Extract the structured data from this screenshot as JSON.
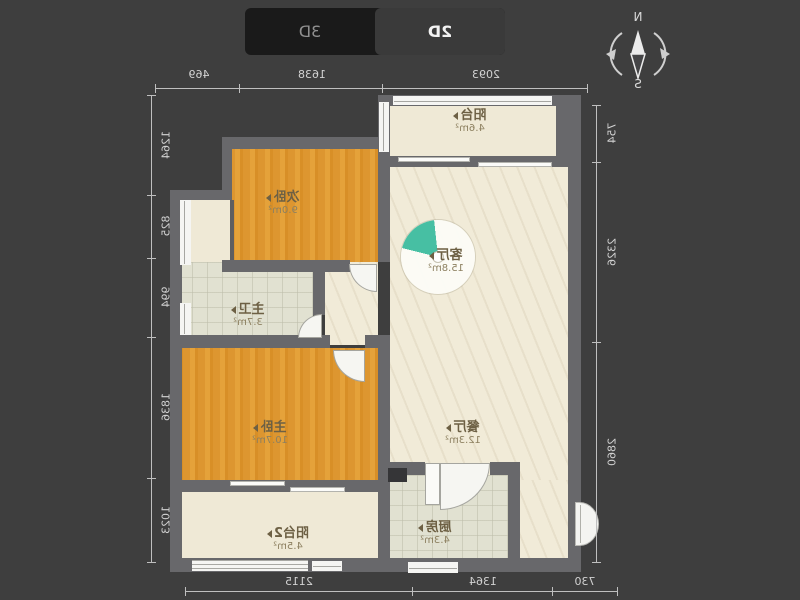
{
  "view_toggle": {
    "selected_label": "2D",
    "other_label": "3D"
  },
  "compass": {
    "north": "N",
    "south": "S"
  },
  "rooms": [
    {
      "id": "balcony",
      "name": "阳台",
      "area": "4.6m²"
    },
    {
      "id": "bedroom2",
      "name": "次卧",
      "area": "9.0m²"
    },
    {
      "id": "living-room",
      "name": "客厅",
      "area": "15.8m²"
    },
    {
      "id": "master-bath",
      "name": "主卫",
      "area": "3.7m²"
    },
    {
      "id": "master-bedroom",
      "name": "主卧",
      "area": "10.7m²"
    },
    {
      "id": "dining-room",
      "name": "餐厅",
      "area": "12.3m²"
    },
    {
      "id": "kitchen",
      "name": "厨房",
      "area": "4.3m²"
    },
    {
      "id": "balcony2",
      "name": "阳台2",
      "area": "4.5m²"
    }
  ],
  "dimensions": {
    "top": [
      "2093",
      "1638",
      "469"
    ],
    "bottom": [
      "730",
      "1364",
      "2115"
    ],
    "left": [
      "754",
      "2326",
      "2860"
    ],
    "right": [
      "1264",
      "825",
      "994",
      "1836",
      "1023"
    ]
  },
  "colors": {
    "background": "#3e3e3e",
    "wall": "#68686b",
    "floor_cream": "#f1ebd8",
    "floor_wood": "#e09a33",
    "floor_tile": "#e1e1d1",
    "accent_teal": "#47bfa3",
    "toggle_selected_bg": "#3a3a3a",
    "dimension_text": "#d2d2d2"
  }
}
